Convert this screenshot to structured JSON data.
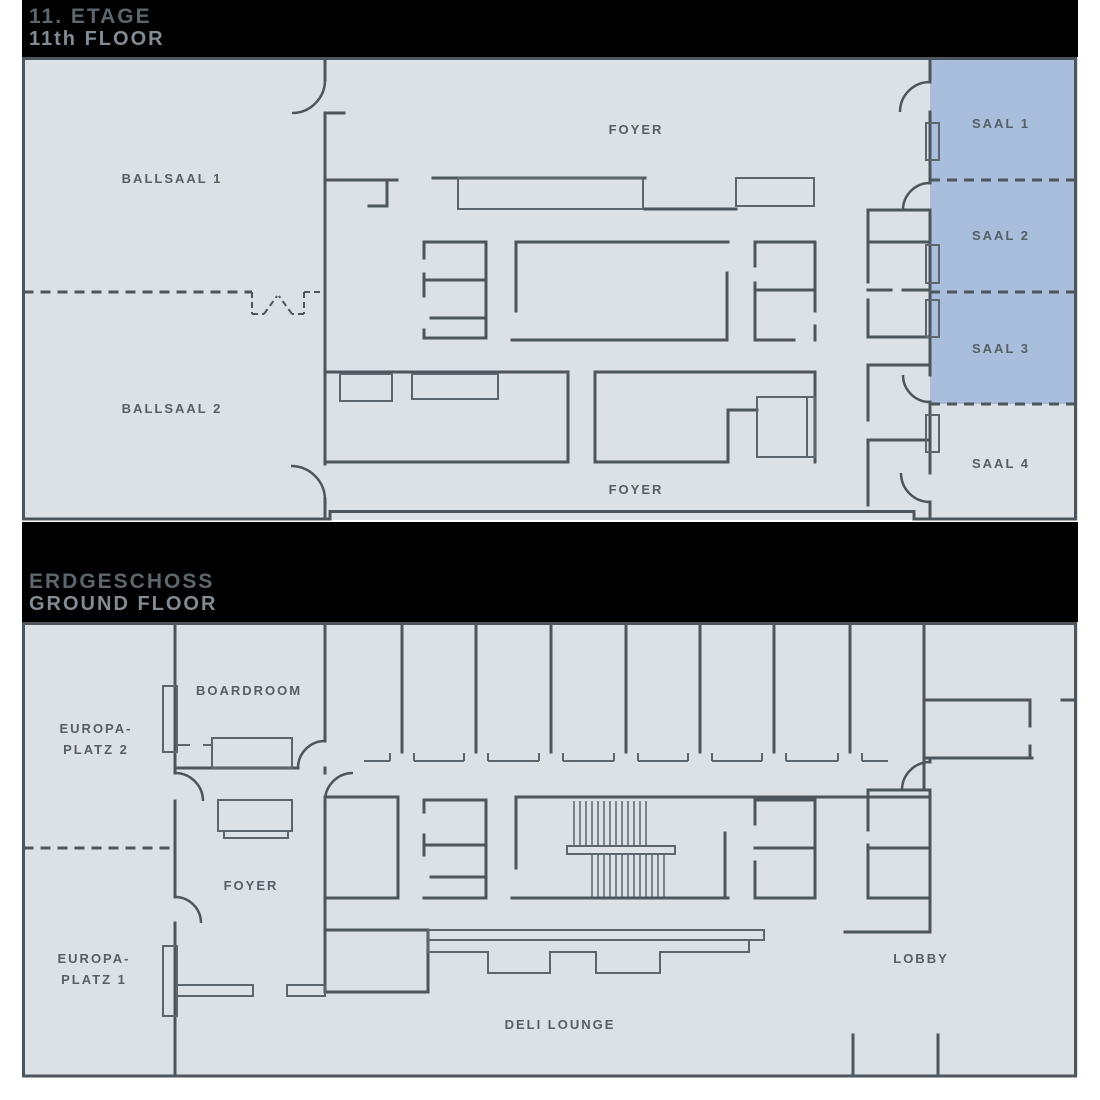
{
  "colors": {
    "page_bg": "#ffffff",
    "header_bg": "#000000",
    "title": "#5c666d",
    "subtitle": "#828c94",
    "floor_fill": "#dce1e5",
    "wall": "#4d565c",
    "furniture": "#5d666d",
    "highlight_fill": "#a9bedd",
    "label": "#555f66"
  },
  "floors": [
    {
      "title": "11. ETAGE",
      "subtitle": "11th FLOOR",
      "labels": {
        "ballsaal1": "BALLSAAL 1",
        "ballsaal2": "BALLSAAL 2",
        "foyer_top": "FOYER",
        "foyer_bottom": "FOYER",
        "saal1": "SAAL 1",
        "saal2": "SAAL 2",
        "saal3": "SAAL 3",
        "saal4": "SAAL 4"
      },
      "highlighted_rooms": [
        "SAAL 1",
        "SAAL 2",
        "SAAL 3"
      ]
    },
    {
      "title": "ERDGESCHOSS",
      "subtitle": "GROUND FLOOR",
      "labels": {
        "europaplatz2_line1": "EUROPA-",
        "europaplatz2_line2": "PLATZ 2",
        "boardroom": "BOARDROOM",
        "foyer": "FOYER",
        "europaplatz1_line1": "EUROPA-",
        "europaplatz1_line2": "PLATZ 1",
        "deli_lounge": "DELI LOUNGE",
        "lobby": "LOBBY"
      }
    }
  ]
}
